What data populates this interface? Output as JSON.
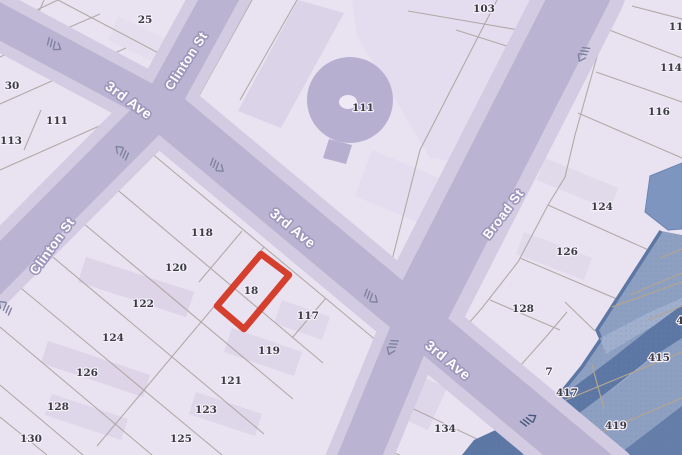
{
  "map": {
    "width": 682,
    "height": 455,
    "selected_parcel": "18",
    "streets": [
      {
        "id": "3rd-ave",
        "name": "3rd Ave"
      },
      {
        "id": "clinton-st",
        "name": "Clinton St"
      },
      {
        "id": "broad-st",
        "name": "Broad St"
      }
    ],
    "street_labels": [
      {
        "text": "3rd Ave",
        "x": 129,
        "y": 100,
        "rotation": 36,
        "size": 14
      },
      {
        "text": "Clinton St",
        "x": 186,
        "y": 61,
        "rotation": -57,
        "size": 13
      },
      {
        "text": "3rd Ave",
        "x": 293,
        "y": 228,
        "rotation": 39,
        "size": 14
      },
      {
        "text": "Clinton St",
        "x": 52,
        "y": 246,
        "rotation": -54,
        "size": 13
      },
      {
        "text": "Broad St",
        "x": 503,
        "y": 214,
        "rotation": -53,
        "size": 13
      },
      {
        "text": "3rd Ave",
        "x": 448,
        "y": 360,
        "rotation": 39,
        "size": 14
      }
    ],
    "parcel_labels": [
      {
        "text": "25",
        "x": 145,
        "y": 20
      },
      {
        "text": "103",
        "x": 484,
        "y": 9
      },
      {
        "text": "111",
        "x": 363,
        "y": 108
      },
      {
        "text": "30",
        "x": 12,
        "y": 86
      },
      {
        "text": "111",
        "x": 57,
        "y": 121
      },
      {
        "text": "113",
        "x": 11,
        "y": 141
      },
      {
        "text": "11",
        "x": 676,
        "y": 27
      },
      {
        "text": "114",
        "x": 671,
        "y": 68
      },
      {
        "text": "116",
        "x": 659,
        "y": 112
      },
      {
        "text": "124",
        "x": 602,
        "y": 207
      },
      {
        "text": "126",
        "x": 567,
        "y": 252
      },
      {
        "text": "128",
        "x": 523,
        "y": 309
      },
      {
        "text": "7",
        "x": 549,
        "y": 372
      },
      {
        "text": "417",
        "x": 567,
        "y": 393
      },
      {
        "text": "415",
        "x": 659,
        "y": 358
      },
      {
        "text": "419",
        "x": 616,
        "y": 426
      },
      {
        "text": "4",
        "x": 680,
        "y": 321
      },
      {
        "text": "118",
        "x": 202,
        "y": 233
      },
      {
        "text": "120",
        "x": 176,
        "y": 268
      },
      {
        "text": "122",
        "x": 143,
        "y": 304
      },
      {
        "text": "124",
        "x": 113,
        "y": 338
      },
      {
        "text": "126",
        "x": 87,
        "y": 373
      },
      {
        "text": "128",
        "x": 58,
        "y": 407
      },
      {
        "text": "130",
        "x": 31,
        "y": 439
      },
      {
        "text": "18",
        "x": 251,
        "y": 291
      },
      {
        "text": "117",
        "x": 308,
        "y": 316
      },
      {
        "text": "119",
        "x": 269,
        "y": 351
      },
      {
        "text": "121",
        "x": 231,
        "y": 381
      },
      {
        "text": "123",
        "x": 206,
        "y": 410
      },
      {
        "text": "125",
        "x": 181,
        "y": 439
      },
      {
        "text": "134",
        "x": 445,
        "y": 429
      }
    ],
    "oneway_arrows": [
      {
        "x": 54,
        "y": 45,
        "rotation": 33,
        "dark": false
      },
      {
        "x": 122,
        "y": 152,
        "rotation": -137,
        "dark": false
      },
      {
        "x": 217,
        "y": 166,
        "rotation": 40,
        "dark": false
      },
      {
        "x": 5,
        "y": 307,
        "rotation": -137,
        "dark": false
      },
      {
        "x": 583,
        "y": 54,
        "rotation": 117,
        "dark": false
      },
      {
        "x": 371,
        "y": 297,
        "rotation": 40,
        "dark": false
      },
      {
        "x": 392,
        "y": 347,
        "rotation": 113,
        "dark": false
      },
      {
        "x": 529,
        "y": 420,
        "rotation": -33,
        "dark": true
      }
    ],
    "palette": {
      "background": "#e9e2f1",
      "building_shade": "#d9d1e6",
      "building_shade_light": "#e0d9ec",
      "circle_building": "#b7afd0",
      "circle_hole": "#efe9f6",
      "parcel_line": "#a8a19b",
      "street_band": "#d2cbe1",
      "street_core": "#bab3d1",
      "parcel_text": "#3b3b44",
      "parcel_text_halo": "#f5f0fa",
      "street_text": "#ffffff",
      "street_text_halo": "#9f97bd",
      "selected_outline": "#d5402e",
      "blue_zone": "#8da0c2",
      "blue_zone_light": "#a6b5d2",
      "blue_zone_dark": "#5d77a5",
      "blue_building": "#7e95bf",
      "blue_building_edge": "#6b84b0",
      "blue_parcel_line": "#b3a58f",
      "arrow": "#7f82a0",
      "arrow_dark": "#44587c"
    }
  }
}
